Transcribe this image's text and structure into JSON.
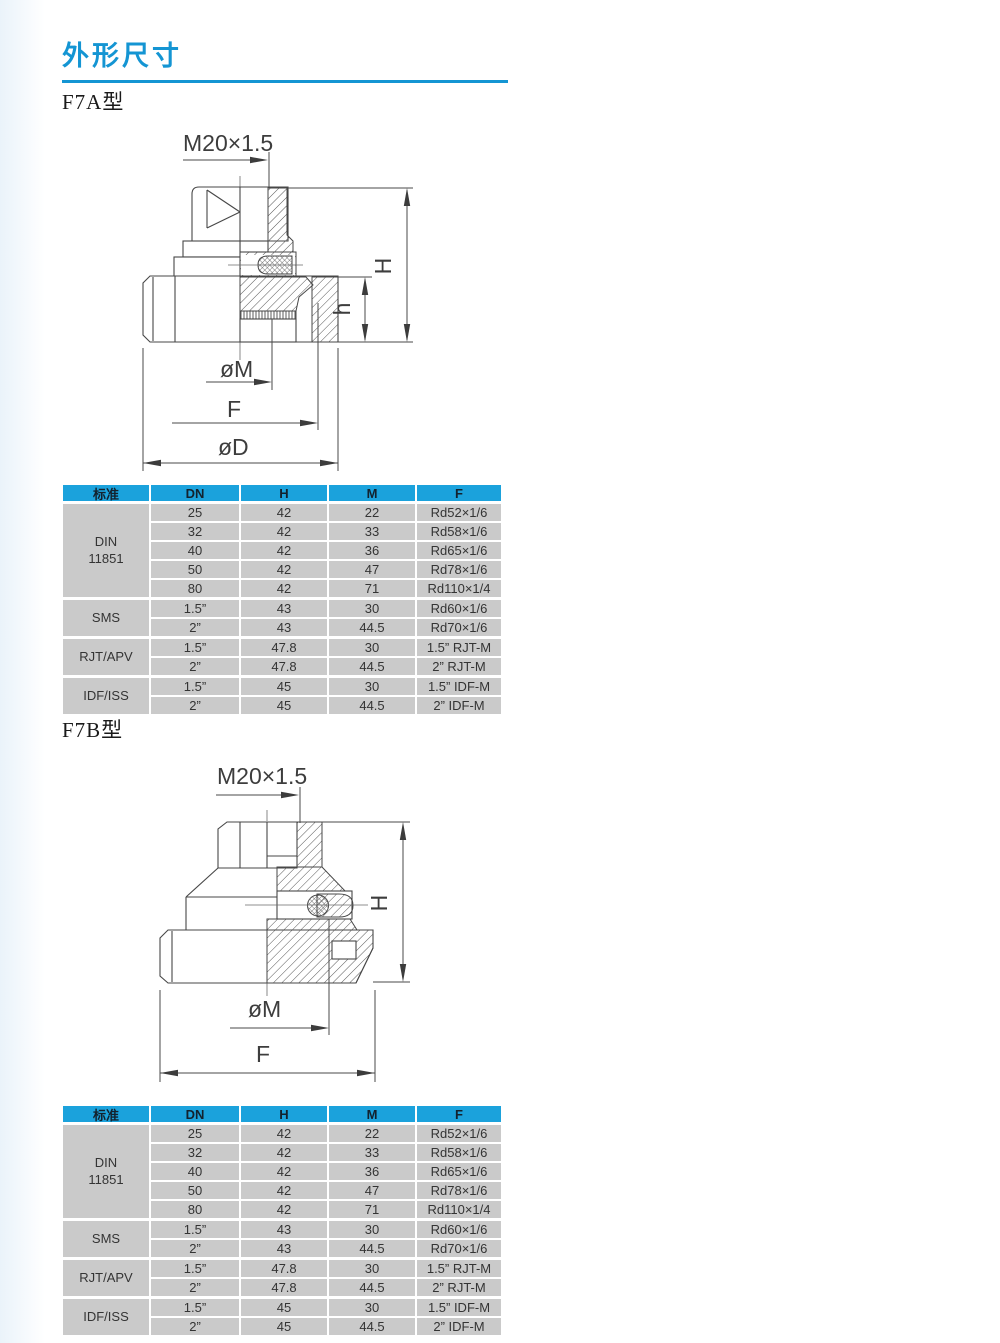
{
  "page_title": "外形尺寸",
  "accent_color": "#1495d3",
  "sections": [
    {
      "id": "f7a",
      "label": "F7A型"
    },
    {
      "id": "f7b",
      "label": "F7B型"
    }
  ],
  "drawings": {
    "f7a": {
      "labels": {
        "thread": "M20×1.5",
        "H": "H",
        "h": "h",
        "M": "øM",
        "F": "F",
        "D": "øD"
      }
    },
    "f7b": {
      "labels": {
        "thread": "M20×1.5",
        "H": "H",
        "M": "øM",
        "F": "F"
      }
    }
  },
  "dimension_table": {
    "headers": [
      "标准",
      "DN",
      "H",
      "M",
      "F"
    ],
    "colors": {
      "header_bg": "#1ba2dc",
      "cell_bg": "#cacaca"
    },
    "groups": [
      {
        "standard": "DIN\n11851",
        "rows": [
          [
            "25",
            "42",
            "22",
            "Rd52×1/6"
          ],
          [
            "32",
            "42",
            "33",
            "Rd58×1/6"
          ],
          [
            "40",
            "42",
            "36",
            "Rd65×1/6"
          ],
          [
            "50",
            "42",
            "47",
            "Rd78×1/6"
          ],
          [
            "80",
            "42",
            "71",
            "Rd110×1/4"
          ]
        ]
      },
      {
        "standard": "SMS",
        "rows": [
          [
            "1.5”",
            "43",
            "30",
            "Rd60×1/6"
          ],
          [
            "2”",
            "43",
            "44.5",
            "Rd70×1/6"
          ]
        ]
      },
      {
        "standard": "RJT/APV",
        "rows": [
          [
            "1.5”",
            "47.8",
            "30",
            "1.5”  RJT-M"
          ],
          [
            "2”",
            "47.8",
            "44.5",
            "2”  RJT-M"
          ]
        ]
      },
      {
        "standard": "IDF/ISS",
        "rows": [
          [
            "1.5”",
            "45",
            "30",
            "1.5”  IDF-M"
          ],
          [
            "2”",
            "45",
            "44.5",
            "2”  IDF-M"
          ]
        ]
      }
    ]
  }
}
